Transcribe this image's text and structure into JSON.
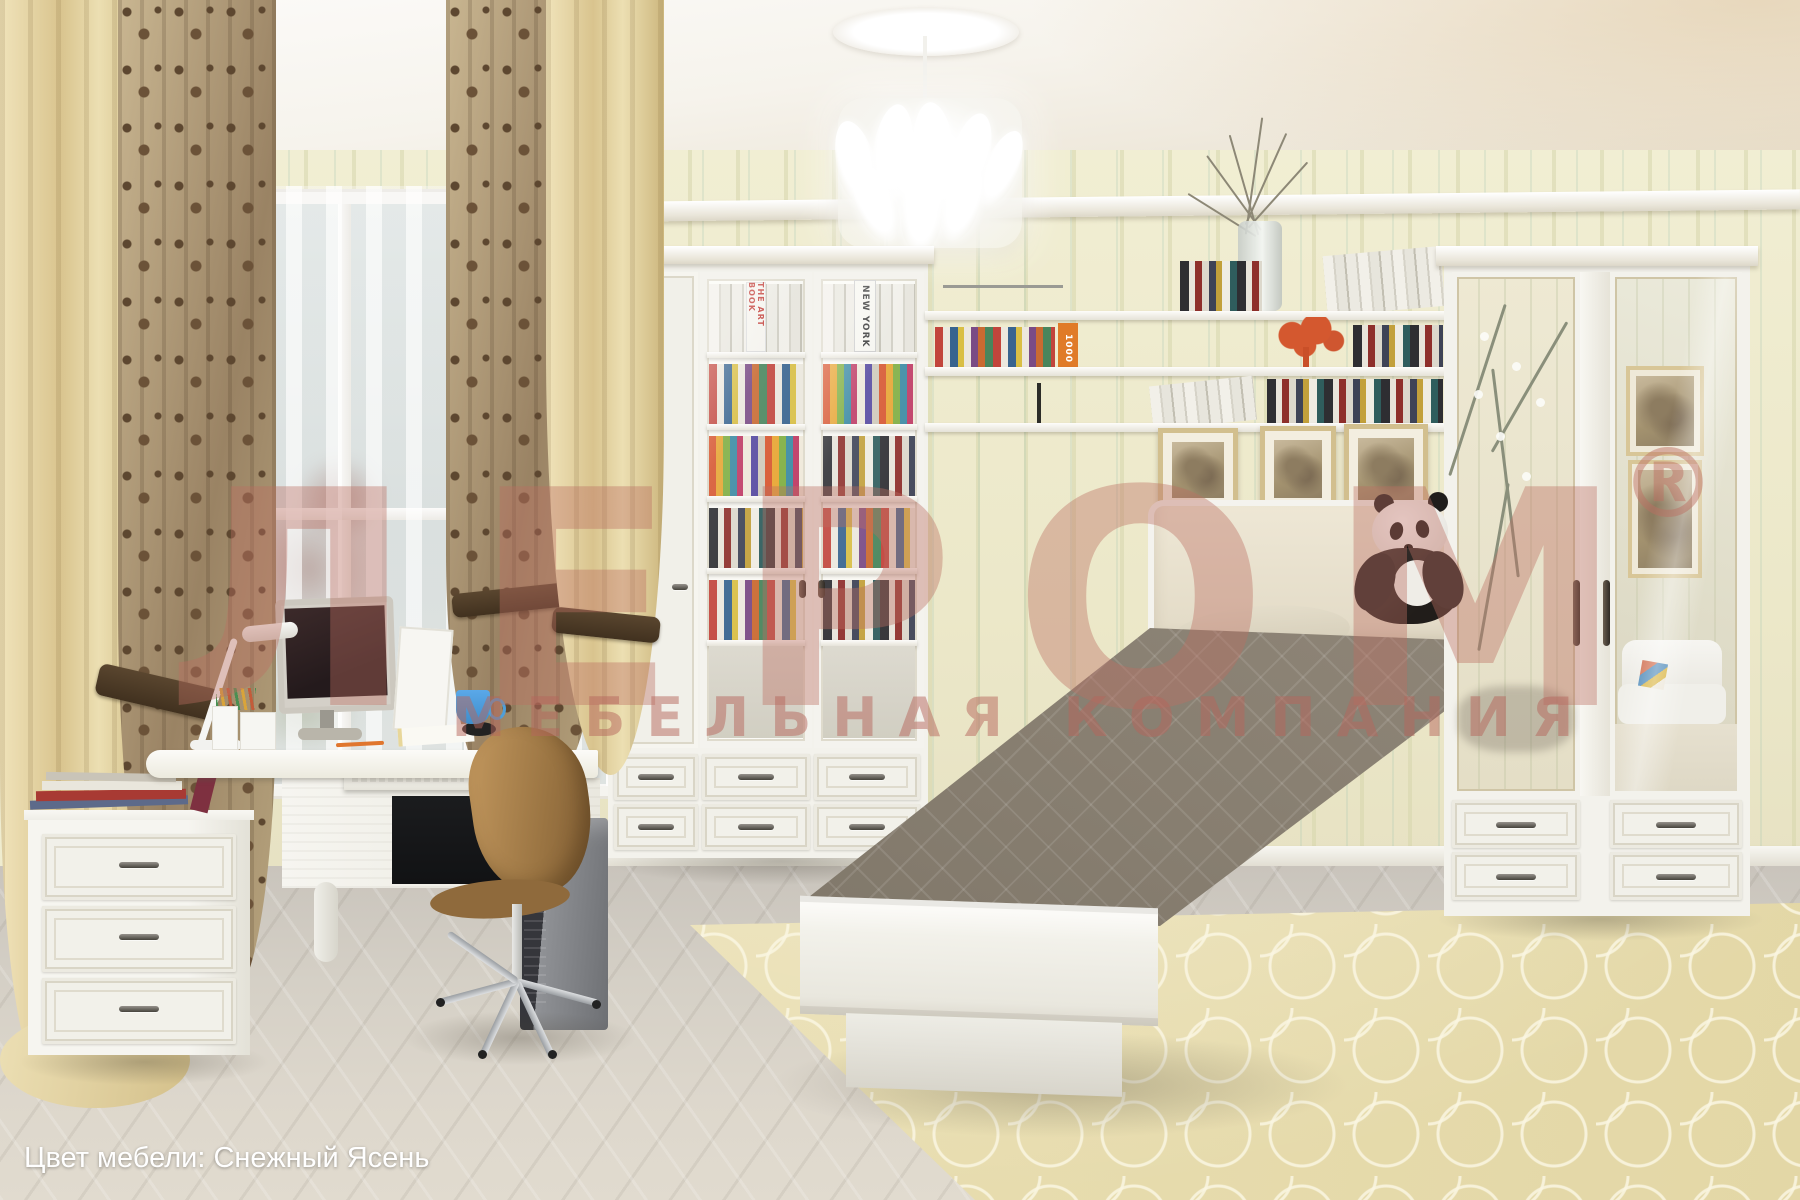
{
  "watermark": {
    "brand": "ЛЕРОМ",
    "registered": "®",
    "subtitle": "МЕБЕЛЬНАЯ КОМПАНИЯ",
    "color": "#bc6e62"
  },
  "caption": {
    "text": "Цвет мебели: Снежный Ясень",
    "color": "#ffffff"
  },
  "books": {
    "art_book": "THE ART BOOK",
    "new_york": "NEW YORK",
    "thousand": "1000"
  },
  "scene": {
    "setting": "teen bedroom furniture set, interior render",
    "furniture_finish": "Снежный Ясень",
    "objects": [
      "window with sheer curtains",
      "cream and damask drapes with tiebacks",
      "white feather chandelier on ceiling medallion",
      "white desk with monitor, lamp, pencil cups, blue mug, keyboard tray",
      "tan office chair on chrome star base",
      "black PC tower",
      "three-drawer nightstand with magazines",
      "bookcase with lattice glass doors full of books",
      "wall shelf with books, dry-branch vase and coral tree ornament",
      "three framed sepia prints above bed",
      "single bed with upholstered headboard and taupe quilted spread",
      "plush panda on bed",
      "two-door wardrobe with decorated mirror doors and four drawers",
      "cream trellis rug",
      "grey herringbone parquet floor"
    ],
    "palette": {
      "wall": "#efeccf",
      "furniture": "#f3f2ec",
      "curtain_cream": "#e3cf9d",
      "curtain_damask": "#8a6f4e",
      "bedspread": "#8d8477",
      "rug": "#eae0b8",
      "floor": "#d2cdc4",
      "decor_coral": "#d4582f",
      "mug_blue": "#4f9fd8"
    }
  }
}
